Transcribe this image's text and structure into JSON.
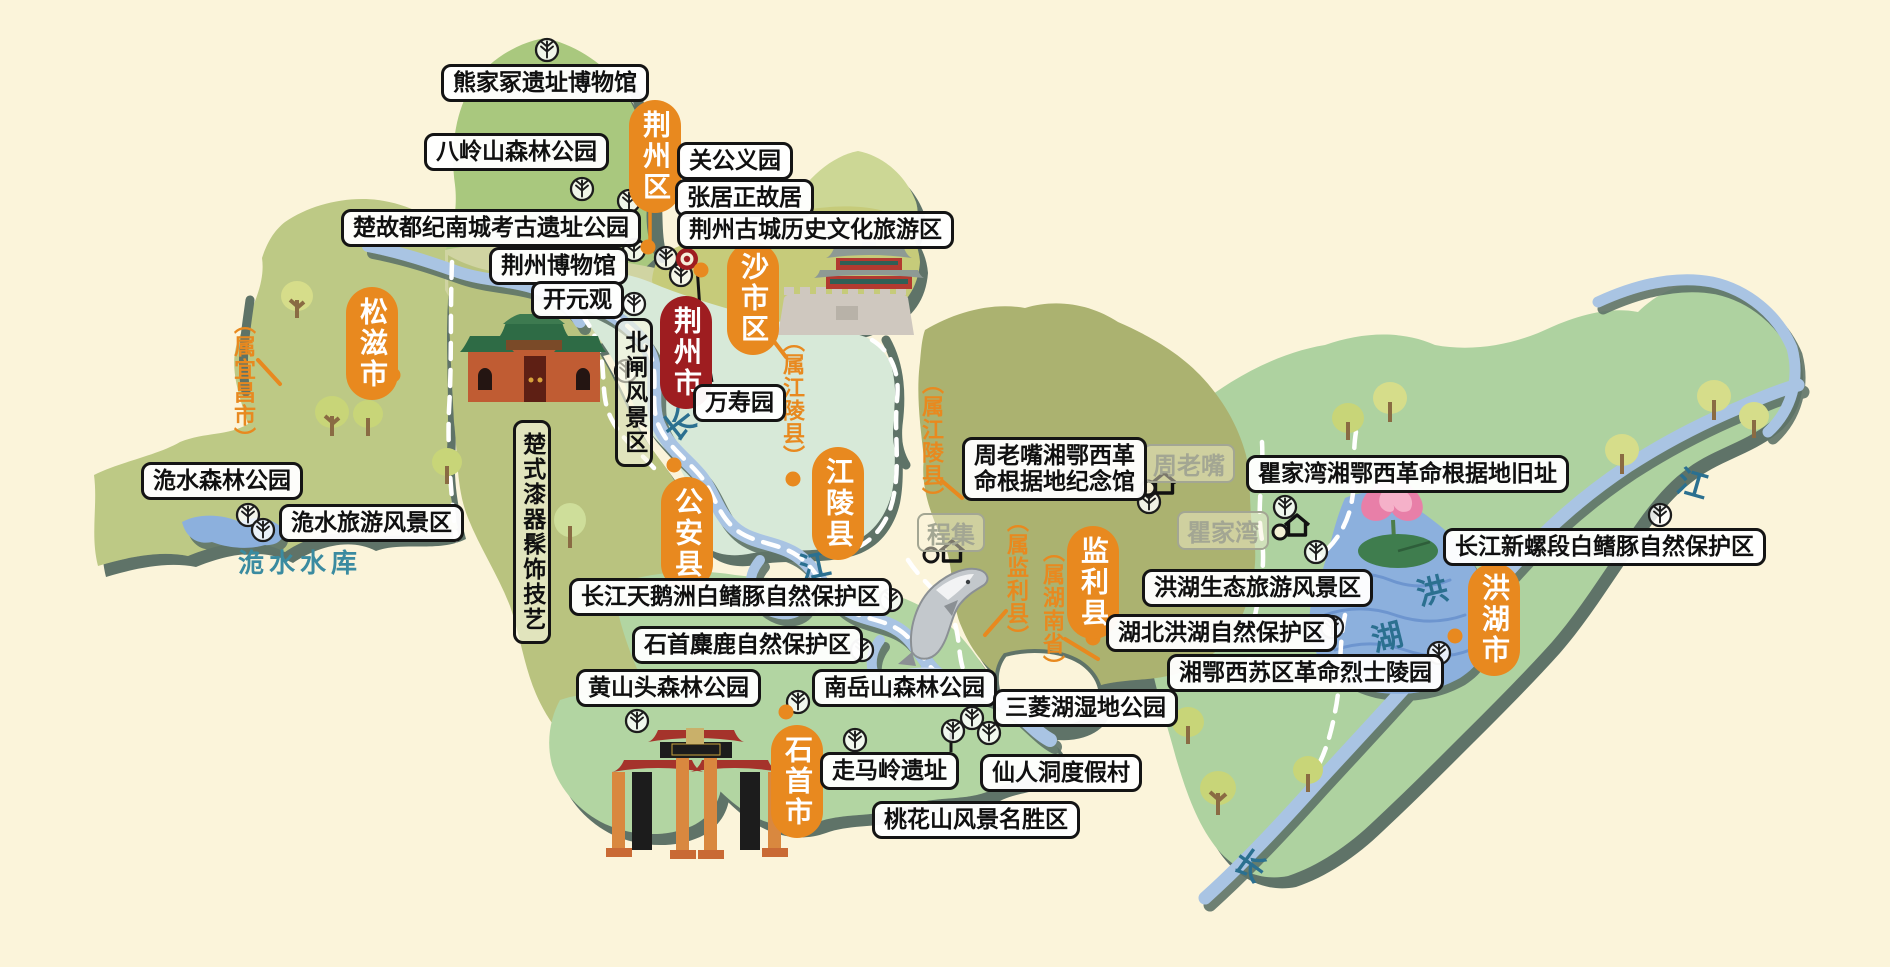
{
  "map_subject": "荆州市",
  "colors": {
    "background": "#fbf4da",
    "shadow": "#5e7367",
    "accent_orange": "#e8891f",
    "city_red": "#9e1d20",
    "river_blue": "#a9c4e3",
    "lake_blue": "#8cb0dd",
    "label_gray": "#a3a693",
    "water_text_teal": "#2b7090",
    "region_olive": "#bdc985",
    "region_olive_dark": "#abb26f",
    "region_green": "#a9c87e",
    "region_yellow_green": "#c6cb7a",
    "region_mint": "#d7e9d8",
    "region_light_green": "#b2d5a2",
    "region_khaki": "#d0d4a2"
  },
  "city_badge": {
    "label": "荆州市",
    "x": 660,
    "y": 296
  },
  "districts": [
    {
      "label": "荆州区",
      "x": 629,
      "y": 100
    },
    {
      "label": "沙市区",
      "x": 727,
      "y": 242
    },
    {
      "label": "松滋市",
      "x": 346,
      "y": 287
    },
    {
      "label": "公安县",
      "x": 661,
      "y": 477
    },
    {
      "label": "江陵县",
      "x": 812,
      "y": 447
    },
    {
      "label": "监利县",
      "x": 1067,
      "y": 526
    },
    {
      "label": "洪湖市",
      "x": 1468,
      "y": 563
    },
    {
      "label": "石首市",
      "x": 771,
      "y": 725
    }
  ],
  "attractions": [
    {
      "label": "熊家冢遗址博物馆",
      "x": 441,
      "y": 64
    },
    {
      "label": "八岭山森林公园",
      "x": 424,
      "y": 133
    },
    {
      "label": "关公义园",
      "x": 677,
      "y": 142
    },
    {
      "label": "张居正故居",
      "x": 675,
      "y": 179
    },
    {
      "label": "荆州古城历史文化旅游区",
      "x": 677,
      "y": 211
    },
    {
      "label": "楚故都纪南城考古遗址公园",
      "x": 341,
      "y": 209
    },
    {
      "label": "荆州博物馆",
      "x": 489,
      "y": 247
    },
    {
      "label": "开元观",
      "x": 531,
      "y": 281
    },
    {
      "label": "万寿园",
      "x": 693,
      "y": 384
    },
    {
      "label": "洈水森林公园",
      "x": 141,
      "y": 462
    },
    {
      "label": "洈水旅游风景区",
      "x": 279,
      "y": 504
    },
    {
      "label": "周老嘴湘鄂西革\n命根据地纪念馆",
      "x": 962,
      "y": 437
    },
    {
      "label": "瞿家湾湘鄂西革命根据地旧址",
      "x": 1246,
      "y": 455
    },
    {
      "label": "长江新螺段白鳍豚自然保护区",
      "x": 1443,
      "y": 528
    },
    {
      "label": "洪湖生态旅游风景区",
      "x": 1142,
      "y": 569
    },
    {
      "label": "湖北洪湖自然保护区",
      "x": 1106,
      "y": 614
    },
    {
      "label": "长江天鹅洲白鳍豚自然保护区",
      "x": 569,
      "y": 578
    },
    {
      "label": "石首麋鹿自然保护区",
      "x": 632,
      "y": 626
    },
    {
      "label": "湘鄂西苏区革命烈士陵园",
      "x": 1167,
      "y": 654
    },
    {
      "label": "黄山头森林公园",
      "x": 576,
      "y": 669
    },
    {
      "label": "南岳山森林公园",
      "x": 812,
      "y": 669
    },
    {
      "label": "三菱湖湿地公园",
      "x": 993,
      "y": 689
    },
    {
      "label": "走马岭遗址",
      "x": 820,
      "y": 752
    },
    {
      "label": "仙人洞度假村",
      "x": 980,
      "y": 754
    },
    {
      "label": "桃花山风景名胜区",
      "x": 872,
      "y": 801
    }
  ],
  "vertical_attractions": [
    {
      "label": "北闸风景区",
      "x": 615,
      "y": 318
    },
    {
      "label": "楚式漆器髹饰技艺",
      "x": 513,
      "y": 420
    }
  ],
  "towns": [
    {
      "label": "周老嘴",
      "x": 1143,
      "y": 444
    },
    {
      "label": "瞿家湾",
      "x": 1177,
      "y": 511
    },
    {
      "label": "程集",
      "x": 917,
      "y": 513
    }
  ],
  "ownership_notes": [
    {
      "label": "（属宜昌市）",
      "x": 227,
      "y": 312
    },
    {
      "label": "（属江陵县）",
      "x": 776,
      "y": 330
    },
    {
      "label": "（属江陵县）",
      "x": 915,
      "y": 372
    },
    {
      "label": "（属监利县）",
      "x": 1000,
      "y": 510
    },
    {
      "label": "（属湖南省）",
      "x": 1036,
      "y": 540
    }
  ],
  "water_labels": [
    {
      "label": "长",
      "x": 662,
      "y": 400,
      "rotate": -38
    },
    {
      "label": "江",
      "x": 799,
      "y": 541,
      "rotate": -12
    },
    {
      "label": "洪",
      "x": 1416,
      "y": 566,
      "rotate": -14
    },
    {
      "label": "湖",
      "x": 1371,
      "y": 612,
      "rotate": -14
    },
    {
      "label": "江",
      "x": 1678,
      "y": 459,
      "rotate": 16
    },
    {
      "label": "长",
      "x": 1236,
      "y": 841,
      "rotate": 36
    },
    {
      "label": "洈水水库",
      "x": 238,
      "y": 543,
      "rotate": 0,
      "small": true
    }
  ],
  "icons": {
    "scenic_trees": [
      [
        547,
        50
      ],
      [
        582,
        189
      ],
      [
        629,
        201
      ],
      [
        634,
        250
      ],
      [
        666,
        258
      ],
      [
        681,
        275
      ],
      [
        634,
        304
      ],
      [
        626,
        371
      ],
      [
        248,
        515
      ],
      [
        263,
        530
      ],
      [
        891,
        600
      ],
      [
        862,
        650
      ],
      [
        637,
        721
      ],
      [
        798,
        702
      ],
      [
        855,
        740
      ],
      [
        953,
        731
      ],
      [
        972,
        718
      ],
      [
        989,
        733
      ],
      [
        1149,
        502
      ],
      [
        1285,
        507
      ],
      [
        1316,
        552
      ],
      [
        1332,
        627
      ],
      [
        1439,
        653
      ],
      [
        1660,
        515
      ]
    ],
    "town_houses": [
      [
        1164,
        484
      ],
      [
        1297,
        526
      ],
      [
        952,
        552
      ]
    ],
    "town_rings": [
      [
        1148,
        488
      ],
      [
        1280,
        532
      ],
      [
        931,
        555
      ]
    ],
    "city_dots": [
      [
        648,
        247
      ],
      [
        701,
        270
      ],
      [
        393,
        375
      ],
      [
        674,
        465
      ],
      [
        793,
        479
      ],
      [
        1093,
        638
      ],
      [
        1455,
        636
      ],
      [
        786,
        712
      ]
    ],
    "ancient_city_marker": [
      687,
      259
    ]
  }
}
